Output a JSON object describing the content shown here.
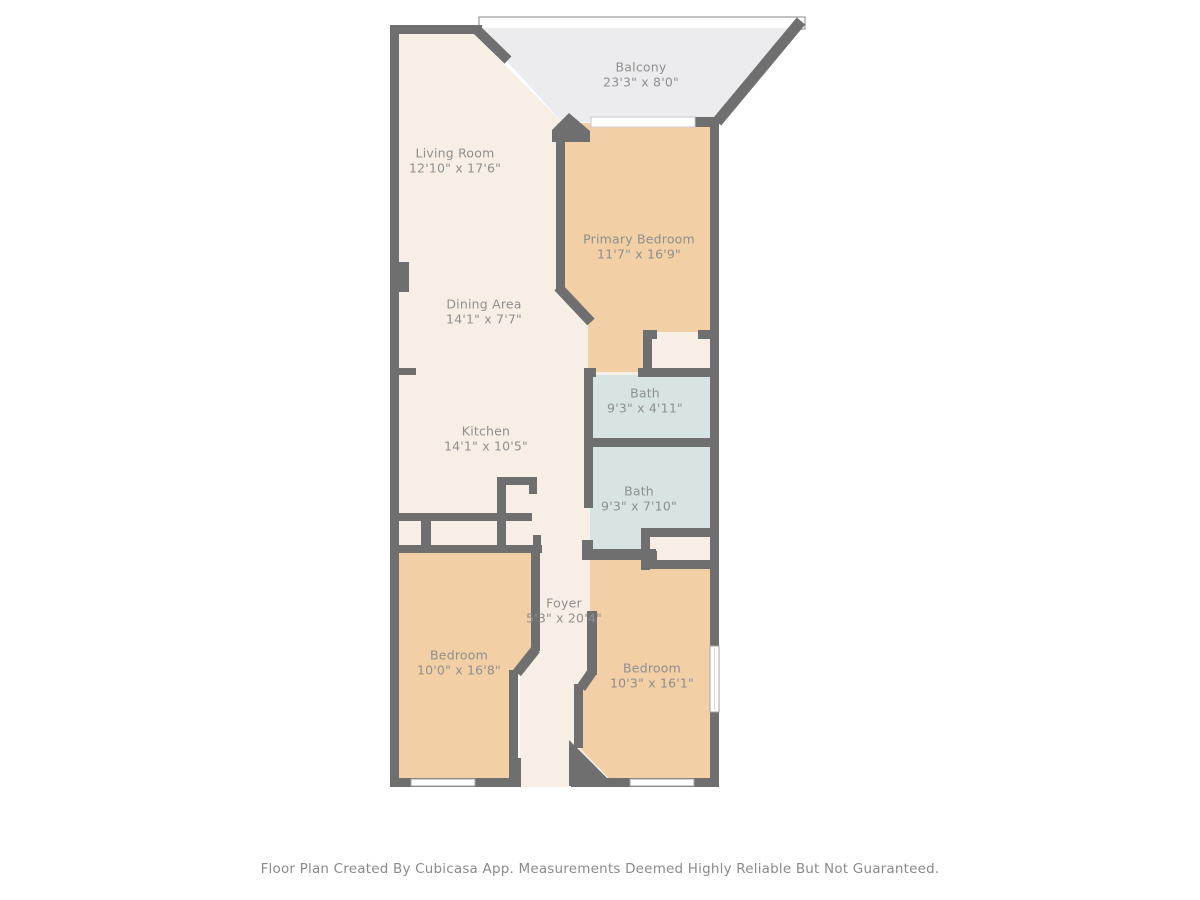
{
  "plan": {
    "colors": {
      "wall": "#6f6f6f",
      "living_floor": "#f7efe6",
      "bedroom_floor": "#f2cfa5",
      "bath_floor": "#d8e4e3",
      "balcony_floor": "#ececee",
      "window_fill": "#ffffff",
      "window_stroke": "#a3a3a3",
      "railing_stroke": "#9b9b9b",
      "label_text": "#8f8f8f"
    },
    "rooms": [
      {
        "id": "balcony",
        "label": "Balcony",
        "dims": "23'3\" x 8'0\""
      },
      {
        "id": "living-room",
        "label": "Living Room",
        "dims": "12'10\" x 17'6\""
      },
      {
        "id": "primary-bedroom",
        "label": "Primary Bedroom",
        "dims": "11'7\" x 16'9\""
      },
      {
        "id": "dining-area",
        "label": "Dining Area",
        "dims": "14'1\" x 7'7\""
      },
      {
        "id": "bath-upper",
        "label": "Bath",
        "dims": "9'3\" x 4'11\""
      },
      {
        "id": "kitchen",
        "label": "Kitchen",
        "dims": "14'1\" x 10'5\""
      },
      {
        "id": "bath-lower",
        "label": "Bath",
        "dims": "9'3\" x 7'10\""
      },
      {
        "id": "foyer",
        "label": "Foyer",
        "dims": "5'3\" x 20'4\""
      },
      {
        "id": "bedroom-left",
        "label": "Bedroom",
        "dims": "10'0\" x 16'8\""
      },
      {
        "id": "bedroom-right",
        "label": "Bedroom",
        "dims": "10'3\" x 16'1\""
      }
    ]
  },
  "footer": {
    "text": "Floor Plan Created By Cubicasa App. Measurements Deemed Highly Reliable But Not Guaranteed."
  }
}
